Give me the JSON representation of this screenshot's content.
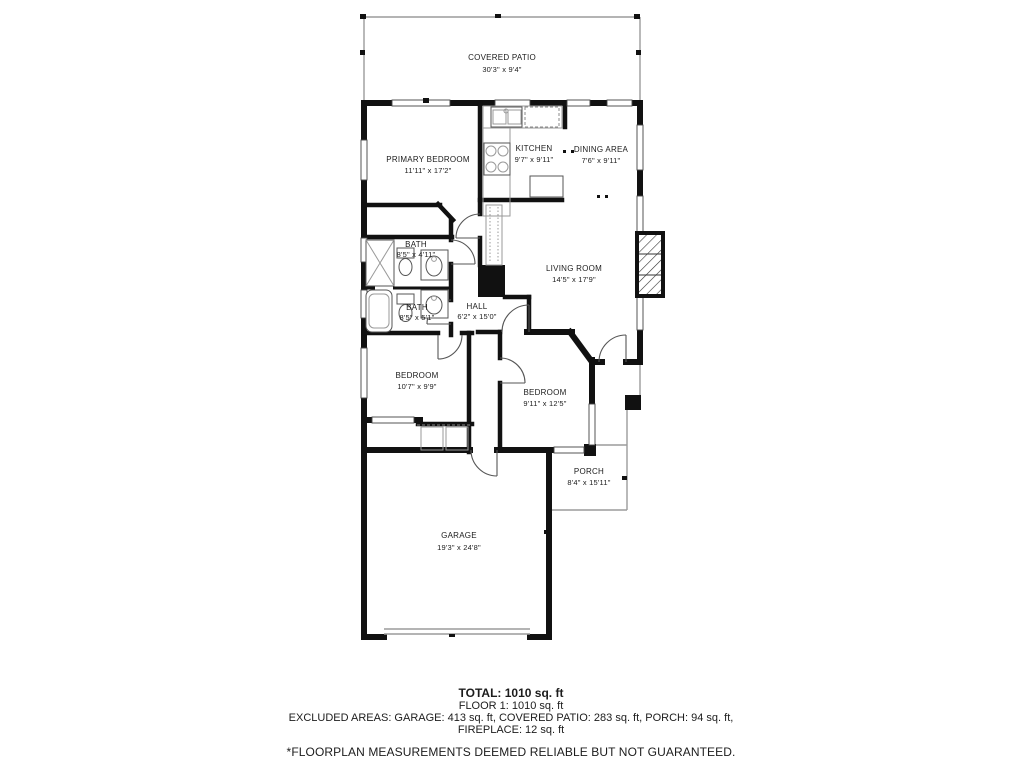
{
  "floorplan": {
    "rooms": {
      "covered_patio": {
        "name": "COVERED PATIO",
        "dims": "30'3\" x 9'4\""
      },
      "primary_bedroom": {
        "name": "PRIMARY BEDROOM",
        "dims": "11'11\" x 17'2\""
      },
      "kitchen": {
        "name": "KITCHEN",
        "dims": "9'7\" x 9'11\""
      },
      "dining": {
        "name": "DINING AREA",
        "dims": "7'6\" x 9'11\""
      },
      "living": {
        "name": "LIVING ROOM",
        "dims": "14'5\" x 17'9\""
      },
      "bath_upper": {
        "name": "BATH",
        "dims": "8'5\" x 4'11\""
      },
      "bath_lower": {
        "name": "BATH",
        "dims": "8'5\" x 5'1\""
      },
      "hall": {
        "name": "HALL",
        "dims": "6'2\" x 15'0\""
      },
      "bedroom_left": {
        "name": "BEDROOM",
        "dims": "10'7\" x 9'9\""
      },
      "bedroom_right": {
        "name": "BEDROOM",
        "dims": "9'11\" x 12'5\""
      },
      "porch": {
        "name": "PORCH",
        "dims": "8'4\" x 15'11\""
      },
      "garage": {
        "name": "GARAGE",
        "dims": "19'3\" x 24'8\""
      }
    },
    "summary": {
      "total": "TOTAL: 1010 sq. ft",
      "floor1": "FLOOR 1: 1010 sq. ft",
      "excluded_line1": "EXCLUDED AREAS: GARAGE: 413 sq. ft, COVERED PATIO: 283 sq. ft, PORCH: 94 sq. ft,",
      "excluded_line2": "FIREPLACE: 12 sq. ft",
      "disclaimer": "*FLOORPLAN MEASUREMENTS DEEMED RELIABLE BUT NOT GUARANTEED."
    },
    "colors": {
      "wall": "#111111",
      "thin_line": "#9b9b9b",
      "fixture": "#555555",
      "background": "#ffffff"
    }
  }
}
